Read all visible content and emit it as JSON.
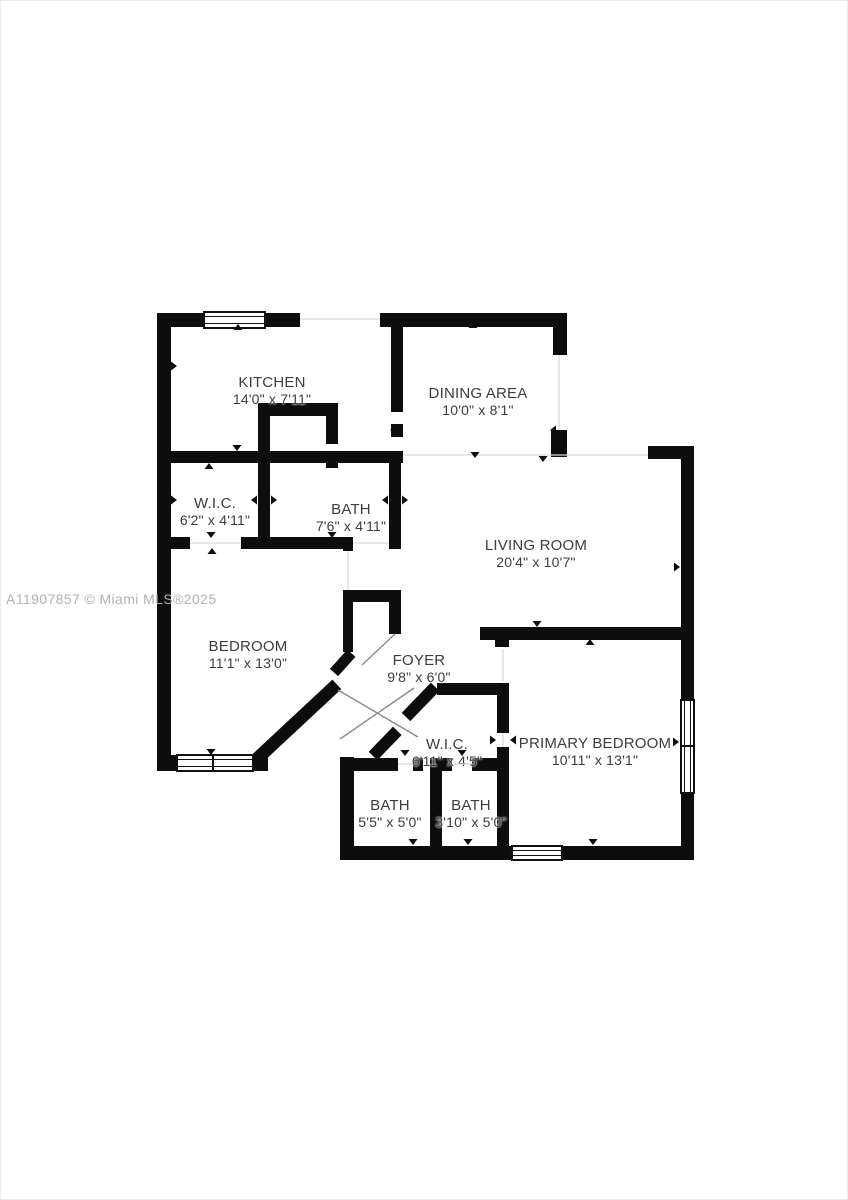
{
  "watermark": "A11907857 © Miami MLS®2025",
  "floor_plan": {
    "rooms": [
      {
        "name": "KITCHEN",
        "dims": "14'0\" x 7'11\""
      },
      {
        "name": "DINING AREA",
        "dims": "10'0\" x 8'1\""
      },
      {
        "name": "W.I.C.",
        "dims": "6'2\" x 4'11\""
      },
      {
        "name": "BATH",
        "dims": "7'6\" x 4'11\""
      },
      {
        "name": "LIVING ROOM",
        "dims": "20'4\" x 10'7\""
      },
      {
        "name": "BEDROOM",
        "dims": "11'1\" x 13'0\""
      },
      {
        "name": "FOYER",
        "dims": "9'8\" x 6'0\""
      },
      {
        "name": "W.I.C.",
        "dims": "6'11\" x 4'5\""
      },
      {
        "name": "PRIMARY BEDROOM",
        "dims": "10'11\" x 13'1\""
      },
      {
        "name": "BATH",
        "dims": "5'5\" x 5'0\""
      },
      {
        "name": "BATH",
        "dims": "3'10\" x 5'0\""
      }
    ],
    "icons": {
      "door_direction_marker": "small black triangle",
      "window_symbol": "double-line rectangle"
    },
    "colors": {
      "wall": "#0d0d0d",
      "label_text": "#3d3d3d",
      "watermark_text": "#b1b1b1",
      "background": "#ffffff"
    }
  }
}
